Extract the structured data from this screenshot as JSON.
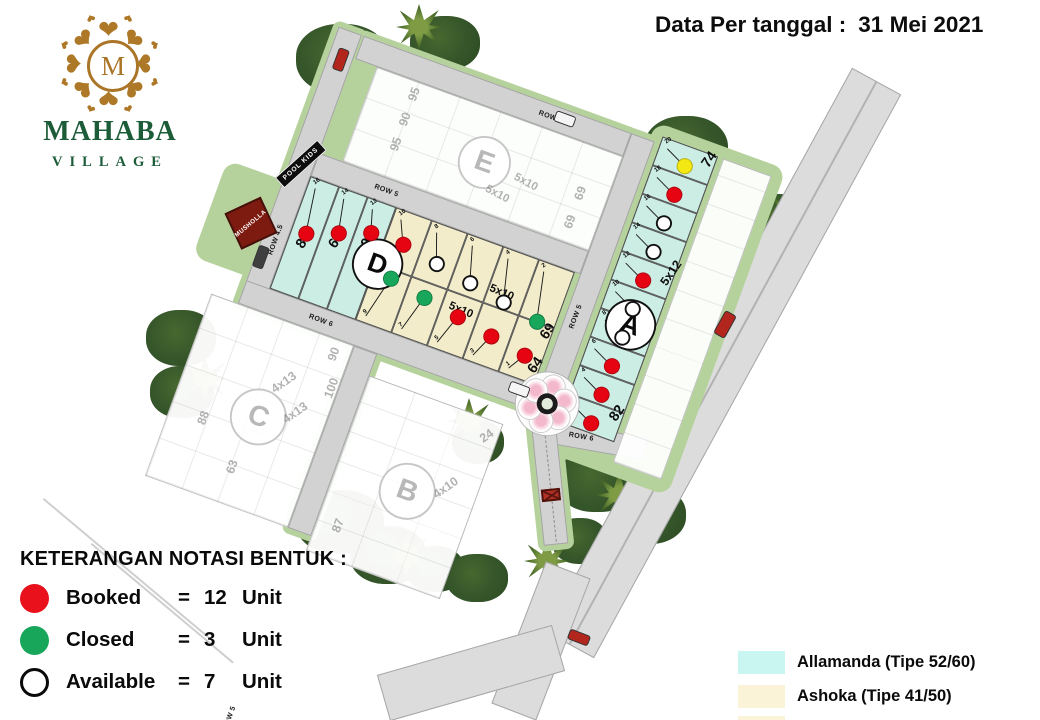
{
  "header": {
    "date_label": "Data Per tanggal :",
    "date_value": "31 Mei 2021"
  },
  "logo": {
    "monogram": "M",
    "name_line1": "MAHABA",
    "name_line2": "VILLAGE"
  },
  "legend_shapes": {
    "heading": "KETERANGAN NOTASI BENTUK :",
    "equals": "=",
    "items": [
      {
        "status": "Booked",
        "count": "12",
        "unit_label": "Unit",
        "color": "#e8111c"
      },
      {
        "status": "Closed",
        "count": "3",
        "unit_label": "Unit",
        "color": "#18a65b"
      },
      {
        "status": "Available",
        "count": "7",
        "unit_label": "Unit",
        "color": "#ffffff"
      }
    ]
  },
  "legend_types": {
    "items": [
      {
        "name": "Allamanda (Tipe 52/60)",
        "color": "#c9f6f0"
      },
      {
        "name": "Ashoka (Tipe 41/50)",
        "color": "#faf3d8"
      }
    ]
  },
  "map": {
    "status_colors": {
      "booked": "#e60413",
      "closed": "#18a65b",
      "available": "#ffffff",
      "yellow": "#f4e812"
    },
    "type_colors": {
      "allamanda": "#cbede4",
      "ashoka": "#f2ecca"
    },
    "road_labels": [
      {
        "text": "ROW 4.5"
      },
      {
        "text": "ROW 4.5"
      },
      {
        "text": "ROW 5"
      },
      {
        "text": "ROW 5"
      },
      {
        "text": "ROW 6"
      },
      {
        "text": "ROW 6"
      },
      {
        "text": "ROW 5"
      }
    ],
    "landmarks": {
      "musholla": "MUSHOLLA",
      "pool_kids": "POOL KIDS"
    },
    "blocks": {
      "A": {
        "letter": "A",
        "size_label": "5x12",
        "plots": [
          {
            "no": "20",
            "status": "yellow",
            "area": "74"
          },
          {
            "no": "18",
            "status": "booked"
          },
          {
            "no": "16",
            "status": "available"
          },
          {
            "no": "14",
            "status": "available"
          },
          {
            "no": "12",
            "status": "booked"
          },
          {
            "no": "10",
            "status": "available"
          },
          {
            "no": "8",
            "status": "available"
          },
          {
            "no": "6",
            "status": "booked"
          },
          {
            "no": "4",
            "status": "booked"
          },
          {
            "no": "2",
            "status": "booked",
            "area": "82"
          }
        ]
      },
      "D": {
        "letter": "D",
        "allamanda_plots": [
          {
            "no": "16",
            "status": "booked",
            "area": "86"
          },
          {
            "no": "14",
            "status": "booked",
            "area": "60"
          },
          {
            "no": "12",
            "status": "booked",
            "area": "95"
          }
        ],
        "ashoka_size_label": "5x10",
        "ashoka_top_row": [
          {
            "no": "10",
            "status": "booked"
          },
          {
            "no": "8",
            "status": "available"
          },
          {
            "no": "6",
            "status": "available"
          },
          {
            "no": "4",
            "status": "available"
          },
          {
            "no": "2",
            "status": "closed",
            "area": "69"
          }
        ],
        "ashoka_bottom_row": [
          {
            "no": "9",
            "status": "closed"
          },
          {
            "no": "7",
            "status": "closed"
          },
          {
            "no": "5",
            "status": "booked"
          },
          {
            "no": "3",
            "status": "booked"
          },
          {
            "no": "1",
            "status": "booked",
            "area": "64"
          }
        ]
      },
      "E": {
        "letter": "E",
        "faint_labels": [
          {
            "text": "95"
          },
          {
            "text": "90"
          },
          {
            "text": "95"
          },
          {
            "text": "5x10"
          },
          {
            "text": "5x10"
          },
          {
            "text": "69"
          },
          {
            "text": "69"
          }
        ]
      },
      "B": {
        "letter": "B",
        "faint_labels": [
          {
            "text": "24"
          },
          {
            "text": "4x10"
          },
          {
            "text": "87"
          }
        ]
      },
      "C": {
        "letter": "C",
        "faint_labels": [
          {
            "text": "90"
          },
          {
            "text": "100"
          },
          {
            "text": "4x13"
          },
          {
            "text": "4x13"
          },
          {
            "text": "88"
          },
          {
            "text": "63"
          }
        ]
      }
    }
  }
}
